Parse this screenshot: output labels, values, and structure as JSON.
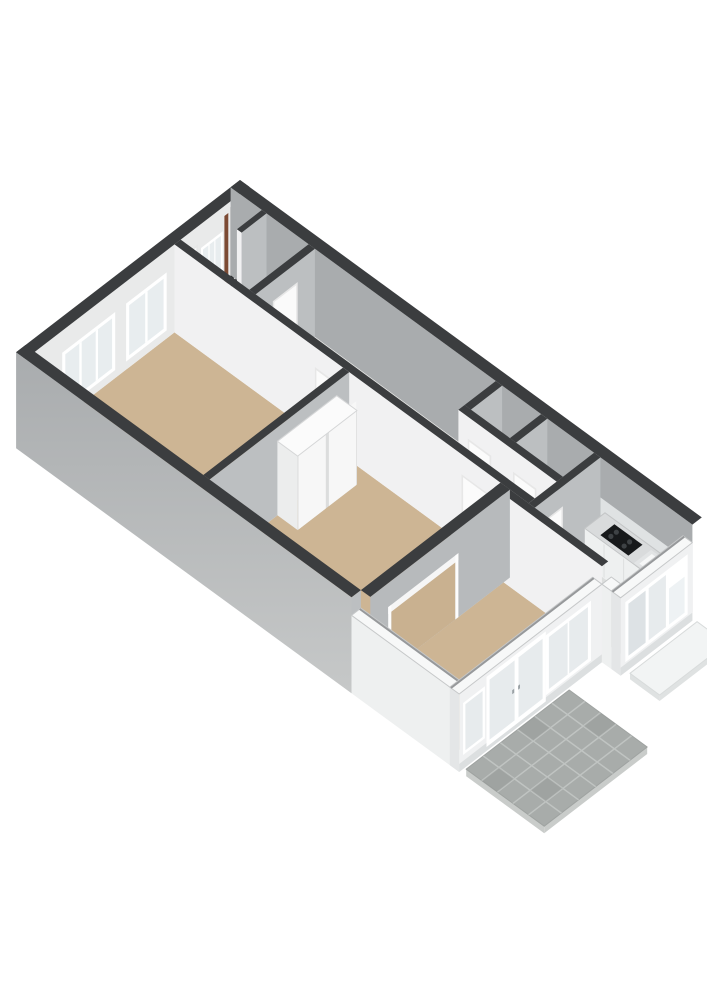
{
  "scene": {
    "type": "3d-floorplan-render",
    "description": "Axonometric 3D floor plan of a single-storey apartment viewed from above, no text labels",
    "background": "#ffffff"
  },
  "canvas": {
    "w": 707,
    "h": 1000,
    "bg": "#ffffff"
  },
  "projection": {
    "origin": [
      240,
      180
    ],
    "ex": [
      0.78,
      0.57
    ],
    "ey": [
      -0.78,
      0.6
    ],
    "floor_z": 88
  },
  "colors": {
    "wall_top_dark": "#3b3d3f",
    "wall_top_white": "#f7f8f8",
    "exterior_face": "#b4b7b9",
    "exterior_inner_face": "#a9acae",
    "interior_face_lit": "#f1f1f2",
    "interior_face_shade": "#bcbfc1",
    "extension_face": "#f0f1f2",
    "floor_room_tan": "#cdb594",
    "floor_service": "#eaeae8",
    "floor_kitchen": "#dcdedd",
    "glass": "#e7ebed",
    "frame_white": "#ffffff",
    "door_leaf": "#fbfbfb",
    "cooktop_black": "#17191b",
    "meter_dark": "#2b2d2f",
    "meter_brown": "#7c4a33",
    "patio_paver": "#a8acaa",
    "patio_joint": "#c0c4c2",
    "pad_top": "#f2f4f4"
  },
  "ground": [
    {
      "name": "patio-terrace",
      "rect": [
        572,
        150,
        672,
        282
      ],
      "z": 94,
      "top": "#a8acaa",
      "edge": "#c9ccca",
      "edge_h": 7,
      "outline": "#9fa3a1",
      "joints": {
        "cols": [
          592,
          612,
          632,
          652
        ],
        "rows": [
          172,
          194,
          216,
          238,
          260
        ],
        "w": 1.6,
        "color": "#c0c4c2"
      },
      "shade": [
        [
          572,
          194,
          592,
          216
        ],
        [
          632,
          238,
          652,
          260
        ],
        [
          612,
          150,
          632,
          172
        ],
        [
          592,
          260,
          612,
          282
        ]
      ],
      "shade_color": "rgba(0,0,0,0.05)"
    },
    {
      "name": "entrance-pad",
      "rect": [
        596,
        10,
        634,
        96
      ],
      "z": 96,
      "top": "#f2f4f4",
      "edge": "#dfe2e2",
      "edge_h": 6,
      "outline": "#d8dbdb"
    }
  ],
  "floors": [
    {
      "name": "floor-hall",
      "rect": [
        12,
        12,
        100,
        88
      ],
      "color": "#eaeae8"
    },
    {
      "name": "floor-corridor",
      "poly": [
        [
          108,
          12
        ],
        [
          340,
          12
        ],
        [
          340,
          60
        ],
        [
          466,
          60
        ],
        [
          466,
          88
        ],
        [
          108,
          88
        ]
      ],
      "color": "#eaeae8"
    },
    {
      "name": "floor-toilet",
      "rect": [
        348,
        12,
        398,
        52
      ],
      "color": "#eaeae8"
    },
    {
      "name": "floor-bathroom",
      "rect": [
        406,
        12,
        466,
        52
      ],
      "color": "#eaeae8"
    },
    {
      "name": "floor-kitchen",
      "poly": [
        [
          474,
          12
        ],
        [
          580,
          12
        ],
        [
          580,
          92
        ],
        [
          568,
          92
        ],
        [
          568,
          104
        ],
        [
          474,
          104
        ]
      ],
      "color": "#dcdedd"
    },
    {
      "name": "floor-living-room",
      "rect": [
        12,
        96,
        228,
        275
      ],
      "color": "#cdb594"
    },
    {
      "name": "floor-bedroom",
      "rect": [
        236,
        96,
        430,
        275
      ],
      "color": "#cdb594"
    },
    {
      "name": "floor-front-room",
      "rect": [
        442,
        104,
        556,
        275
      ],
      "color": "#cdb594"
    }
  ],
  "solids": [
    {
      "name": "wall-back-west",
      "rect": [
        0,
        0,
        12,
        287
      ],
      "top": 0,
      "bot": 88,
      "top_color": "#3b3d3f",
      "face_x": "#e9eaea",
      "fx": [
        [
          13,
          6,
          18,
          86,
          "#2b2d2f"
        ],
        [
          20,
          6,
          24,
          86,
          "#232527"
        ],
        [
          27,
          10,
          32,
          84,
          "#7c4a33"
        ],
        [
          34,
          24,
          62,
          78,
          "#ffffff"
        ],
        [
          36.5,
          27,
          59.5,
          75,
          "#e8edef"
        ],
        [
          43.5,
          27,
          45,
          75,
          "#ffffff"
        ],
        [
          51,
          27,
          52.5,
          75,
          "#ffffff"
        ],
        [
          66,
          18,
          88,
          88,
          "#e6e7e7"
        ],
        [
          68,
          20,
          86,
          88,
          "#fafafa"
        ],
        [
          106,
          22,
          158,
          80,
          "#ffffff"
        ],
        [
          110,
          26,
          154,
          76,
          "#e8edef"
        ],
        [
          130.5,
          26,
          133.5,
          76,
          "#ffffff"
        ],
        [
          172,
          22,
          240,
          80,
          "#ffffff"
        ],
        [
          176,
          26,
          236,
          76,
          "#e8edef"
        ],
        [
          194,
          26,
          197,
          76,
          "#ffffff"
        ],
        [
          215,
          26,
          218,
          76,
          "#ffffff"
        ]
      ]
    },
    {
      "name": "wall-north",
      "rect": [
        0,
        0,
        592,
        12
      ],
      "top": 0,
      "bot": 88,
      "top_color": "#3b3d3f",
      "face_y": "#a9acae",
      "fy": [
        [
          474,
          40,
          584,
          88,
          "#dfe2e3"
        ]
      ]
    },
    {
      "name": "wall-meter-closet",
      "rect": [
        40,
        12,
        46,
        44
      ],
      "top": 0,
      "bot": 88,
      "top_color": "#3b3d3f",
      "face_x": "#bcbfc1",
      "face_y": "#f1f1f2"
    },
    {
      "name": "wall-hall-corridor",
      "rect": [
        100,
        12,
        108,
        88
      ],
      "top": 0,
      "bot": 88,
      "top_color": "#3b3d3f",
      "face_x": "#bcbfc1",
      "fx": [
        [
          22,
          20,
          54,
          88,
          "#e7e7e7"
        ],
        [
          24,
          22,
          52,
          88,
          "#fafafa"
        ]
      ]
    },
    {
      "name": "wall-toilet-left",
      "rect": [
        340,
        12,
        348,
        52
      ],
      "top": 0,
      "bot": 88,
      "top_color": "#3b3d3f",
      "face_x": "#bcbfc1"
    },
    {
      "name": "wall-toilet-bathroom",
      "rect": [
        398,
        12,
        406,
        52
      ],
      "top": 0,
      "bot": 88,
      "top_color": "#3b3d3f",
      "face_x": "#bcbfc1"
    },
    {
      "name": "wall-toilet-front",
      "rect": [
        340,
        52,
        466,
        60
      ],
      "top": 0,
      "bot": 88,
      "top_color": "#3b3d3f",
      "face_y": "#f1f1f2",
      "fy": [
        [
          12,
          22,
          42,
          88,
          "#e7e7e7"
        ],
        [
          14,
          24,
          40,
          88,
          "#fbfbfb"
        ],
        [
          70,
          22,
          100,
          88,
          "#e7e7e7"
        ],
        [
          72,
          24,
          98,
          88,
          "#fbfbfb"
        ]
      ]
    },
    {
      "name": "wall-kitchen-entry",
      "rect": [
        466,
        12,
        474,
        96
      ],
      "top": 0,
      "bot": 88,
      "top_color": "#3b3d3f",
      "face_x": "#bcbfc1",
      "fx": [
        [
          48,
          20,
          76,
          88,
          "#e7e7e7"
        ],
        [
          50,
          22,
          74,
          88,
          "#fbfbfb"
        ],
        [
          74,
          22,
          76,
          88,
          "#6a6c6e"
        ]
      ]
    },
    {
      "name": "kitchen-counter",
      "rect": [
        480,
        12,
        580,
        38
      ],
      "top": 52,
      "bot": 88,
      "top_color": "#d9dbdc",
      "top_stroke": "#c3c5c6",
      "face_x": "#e4e5e6",
      "face_y": "#eef0f0",
      "fy": [
        [
          24,
          54,
          25.5,
          87,
          "#dfe1e1"
        ],
        [
          49,
          54,
          50.5,
          87,
          "#dfe1e1"
        ],
        [
          74,
          54,
          75.5,
          87,
          "#dfe1e1"
        ]
      ],
      "tops": [
        [
          496,
          16,
          532,
          34,
          "#17191b"
        ],
        [
          542,
          15,
          576,
          37,
          "#e2e4e5"
        ],
        [
          546,
          18,
          572,
          34,
          "#f6f7f7"
        ],
        [
          557,
          12,
          561,
          16,
          "#9aa1a5"
        ]
      ],
      "dots": [
        [
          504,
          21.5,
          2.6,
          "#3e4245"
        ],
        [
          504,
          28.5,
          2.6,
          "#3e4245"
        ],
        [
          521,
          21.5,
          2.6,
          "#3e4245"
        ],
        [
          521,
          28.5,
          2.6,
          "#3e4245"
        ],
        [
          559,
          17.5,
          2.2,
          "#9aa1a5"
        ]
      ]
    },
    {
      "name": "wall-corridor-rooms",
      "rect": [
        12,
        88,
        466,
        96
      ],
      "top": 0,
      "bot": 88,
      "top_color": "#3b3d3f",
      "face_y": "#f1f1f2",
      "fy": [
        [
          180,
          20,
          214,
          88,
          "#e7e7e7"
        ],
        [
          182,
          22,
          212,
          88,
          "#fbfbfb"
        ],
        [
          368,
          20,
          402,
          88,
          "#e7e7e7"
        ],
        [
          370,
          22,
          400,
          88,
          "#fbfbfb"
        ]
      ]
    },
    {
      "name": "wall-living-bedroom",
      "rect": [
        228,
        96,
        236,
        275
      ],
      "top": 0,
      "bot": 88,
      "top_color": "#3b3d3f",
      "face_x": "#bcbfc1"
    },
    {
      "name": "radiator-living-left",
      "rect": [
        54,
        256,
        118,
        270
      ],
      "top": 58,
      "bot": 88,
      "top_color": "#fcfcfc",
      "top_stroke": "#c9cacb",
      "face_x": "#e3e4e4",
      "face_y": "#f0f1f1",
      "tops": [
        [
          58,
          261,
          114,
          265,
          "#4b4d4f"
        ]
      ]
    },
    {
      "name": "radiator-living-right",
      "rect": [
        118,
        262,
        184,
        276
      ],
      "top": 58,
      "bot": 88,
      "top_color": "#fcfcfc",
      "top_stroke": "#c9cacb",
      "face_x": "#e3e4e4",
      "face_y": "#f0f1f1",
      "tops": [
        [
          122,
          267,
          180,
          271,
          "#4b4d4f"
        ]
      ]
    },
    {
      "name": "wardrobe-bedroom",
      "rect": [
        236,
        112,
        262,
        188
      ],
      "top": 14,
      "bot": 88,
      "top_color": "#fbfbfb",
      "top_stroke": "#d5d6d7",
      "face_x": "#dcdddd",
      "face_y": "#eceded",
      "fx": [
        [
          1,
          4,
          36,
          88,
          "#f7f7f7"
        ],
        [
          40,
          4,
          75,
          88,
          "#f7f7f7"
        ]
      ]
    },
    {
      "name": "wall-hall-frontroom",
      "rect": [
        430,
        96,
        568,
        104
      ],
      "top": 0,
      "bot": 88,
      "top_color": "#3b3d3f",
      "face_y": "#f1f1f2"
    },
    {
      "name": "wall-bedroom-frontroom-opening",
      "rect": [
        430,
        96,
        442,
        275
      ],
      "top": 0,
      "bot": 88,
      "top_color": "#3b3d3f",
      "face_x": "#b7babc",
      "fx": [
        [
          70,
          30,
          152,
          88,
          "#c9b190"
        ],
        [
          66,
          24,
          156,
          31,
          "#f6f6f6"
        ],
        [
          66,
          24,
          70,
          88,
          "#fdfdfd"
        ],
        [
          152,
          24,
          156,
          88,
          "#fdfdfd"
        ]
      ]
    },
    {
      "name": "wall-south",
      "rect": [
        0,
        275,
        430,
        287
      ],
      "top": 0,
      "bot": 96,
      "top_color": "#3b3d3f",
      "face_x": "#bcbfc1",
      "face_y": "url(#gradient-outer)"
    },
    {
      "name": "wall-extension-left",
      "rect": [
        430,
        275,
        568,
        287
      ],
      "top": 18,
      "bot": 96,
      "top_color": "#f7f8f8",
      "top_stroke": "#c6c8c9",
      "inner_edge": [
        [
          430,
          276.5
        ],
        [
          568,
          276.5
        ]
      ],
      "face_y": "#eef0f0"
    },
    {
      "name": "wall-facade-french-doors",
      "rect": [
        556,
        104,
        568,
        287
      ],
      "top": 18,
      "bot": 96,
      "top_color": "#f7f8f8",
      "top_stroke": "#c6c8c9",
      "inner_edge": [
        [
          557.5,
          104
        ],
        [
          557.5,
          287
        ]
      ],
      "face_x": "#f0f1f2",
      "face_y": "#e4e6e7",
      "fx": [
        [
          0,
          88,
          183,
          96,
          "#dcdfe0"
        ],
        [
          14,
          26,
          72,
          86,
          "#ffffff"
        ],
        [
          18,
          30,
          68,
          82,
          "#e7ebed"
        ],
        [
          42,
          30,
          44,
          82,
          "#ffffff"
        ],
        [
          72,
          22,
          148,
          92,
          "#ffffff"
        ],
        [
          76,
          27,
          108,
          87,
          "#e7ebed"
        ],
        [
          107,
          27,
          113,
          87,
          "#ffffff"
        ],
        [
          112,
          27,
          144,
          87,
          "#e7ebed"
        ],
        [
          105,
          55,
          107.5,
          59,
          "#9aa1a5"
        ],
        [
          112.5,
          55,
          115,
          59,
          "#9aa1a5"
        ],
        [
          150,
          30,
          178,
          82,
          "#ffffff"
        ],
        [
          153,
          33,
          175,
          79,
          "#e7ebed"
        ]
      ]
    },
    {
      "name": "wall-kitchen-ext-side",
      "rect": [
        568,
        92,
        580,
        104
      ],
      "top": 18,
      "bot": 96,
      "top_color": "#f7f8f8",
      "top_stroke": "#c6c8c9",
      "face_y": "#eef0f0"
    },
    {
      "name": "wall-kitchen-ext-front-window",
      "rect": [
        580,
        12,
        592,
        104
      ],
      "top": 18,
      "bot": 96,
      "top_color": "#f7f8f8",
      "top_stroke": "#c6c8c9",
      "inner_edge": [
        [
          581.5,
          12
        ],
        [
          581.5,
          104
        ]
      ],
      "face_x": "#f0f1f2",
      "face_y": "#e4e6e7",
      "fx": [
        [
          0,
          88,
          92,
          96,
          "#dcdfe0"
        ],
        [
          6,
          26,
          86,
          86,
          "#ffffff"
        ],
        [
          10,
          46,
          30,
          82,
          "#eef2f4"
        ],
        [
          34,
          30,
          56,
          82,
          "#e7ebed"
        ],
        [
          60,
          30,
          82,
          82,
          "#dde2e5"
        ]
      ]
    }
  ]
}
